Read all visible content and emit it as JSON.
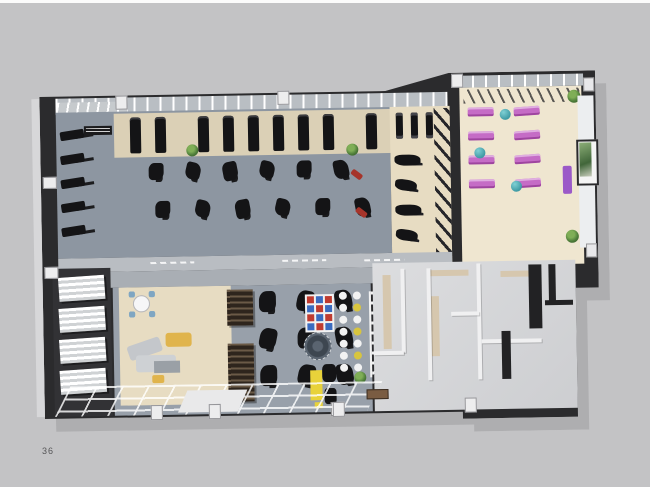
{
  "page": {
    "number": "36"
  },
  "palette": {
    "page_bg": "#c3c3c5",
    "top_strip": "#fbfbfb",
    "wall_dark": "#2b2b2d",
    "wall_face": "#b9bdc2",
    "shadow": "#aeaeb0",
    "floor_gym": "#8d96a1",
    "floor_corridor": "#a9aeb4",
    "floor_wood": "#e7dcc2",
    "floor_wood_light": "#efe6d0",
    "beige_strip": "#dbd0b6",
    "tan_accent": "#d6c7ae",
    "equip_black": "#141416",
    "mat_purple": "#c56cc6",
    "ball_teal": "#3f9aa4",
    "sofa_yellow": "#e0b44c",
    "chair_blue": "#7fa6c2",
    "bench_red": "#a6342a",
    "plant_green": "#4e7d3a",
    "grid_red": "#c03b30",
    "grid_blue": "#3a6bc0",
    "dot_yellow": "#d8c53e",
    "kids_yellow": "#e8d23a"
  },
  "scene": {
    "kind": "3d-gym-floorplan-render",
    "counts": {
      "treadmills": 11,
      "left_wall_racks": 5,
      "strength_machines_row_a": 6,
      "strength_machines_row_b": 6,
      "free_weight_racks": 3,
      "free_weight_benches": 4,
      "yoga_mats": 8,
      "exercise_balls": 3,
      "shelf_units": 4,
      "cafe_tables": 2,
      "spin_bikes": 9,
      "floor_grid_cells": 12,
      "floor_dots": 14
    },
    "rooms": [
      "main-gym",
      "free-weights-area",
      "yoga-studio",
      "corridor",
      "retail-shelving",
      "lounge",
      "cardio-room",
      "functional-zone",
      "changing-rooms",
      "entrance"
    ]
  }
}
